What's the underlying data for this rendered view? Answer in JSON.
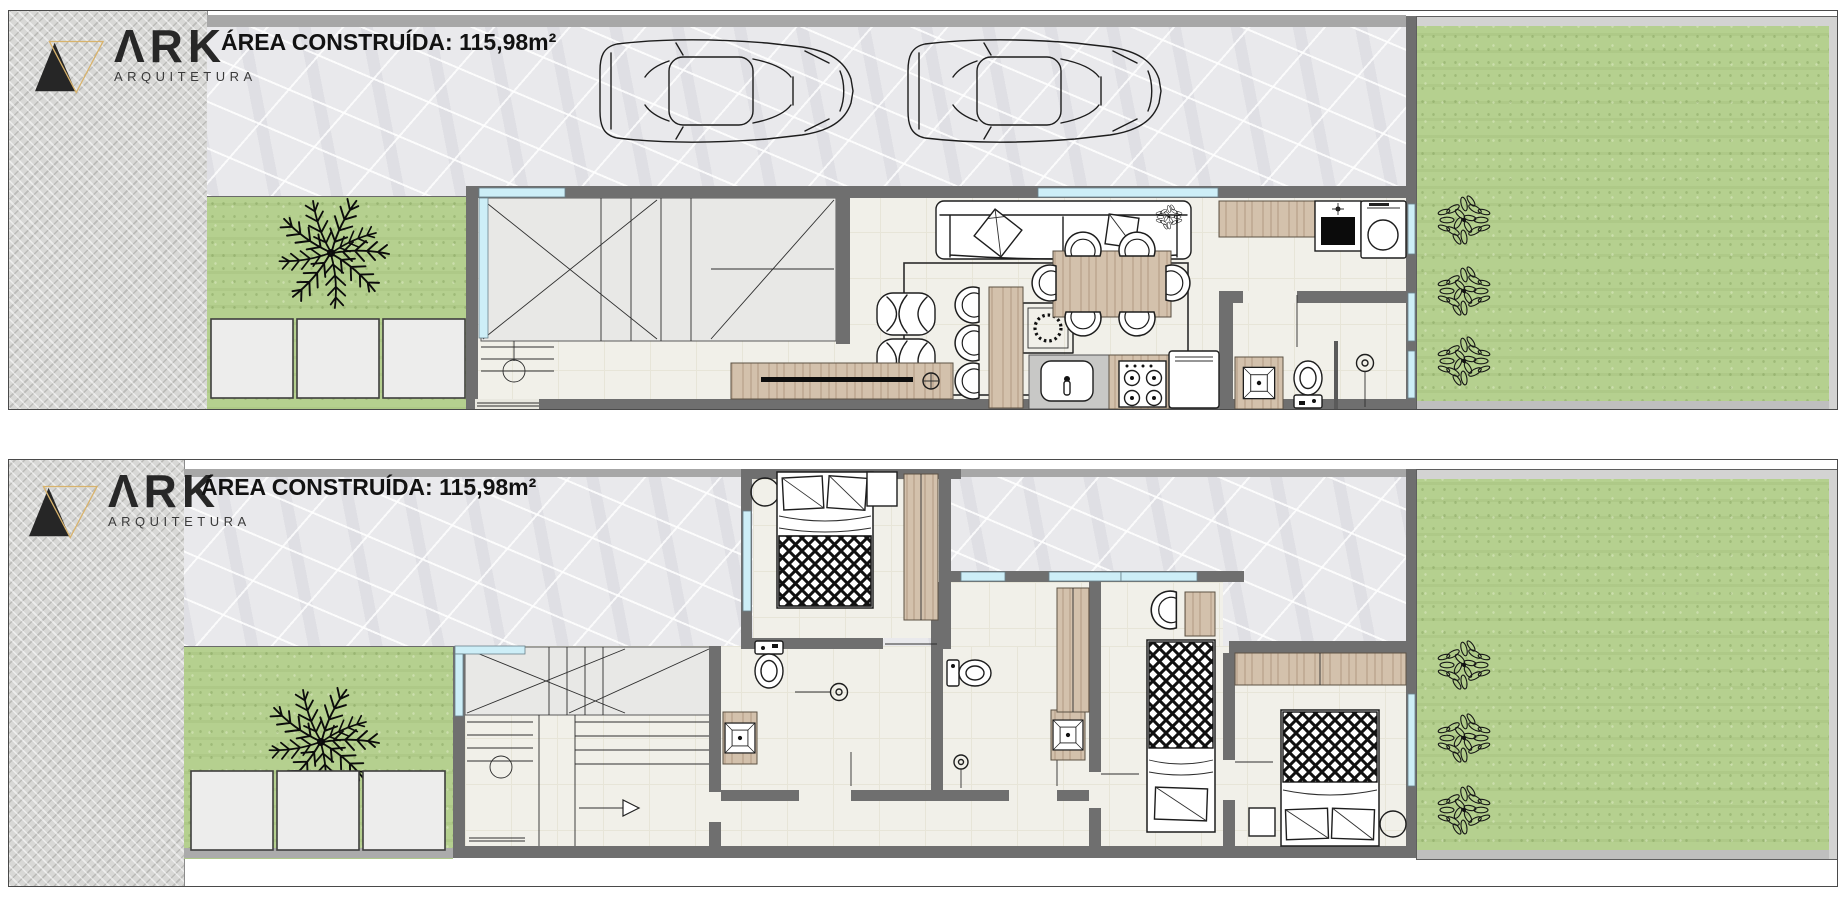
{
  "branding": {
    "name": "ARK",
    "logo_display": "ΛRK",
    "subtitle": "ARQUITETURA"
  },
  "plans": [
    {
      "id": "pavimento-1",
      "area_label": "ÁREA CONSTRUÍDA: 115,98m²"
    },
    {
      "id": "pavimento-2",
      "area_label": "ÁREA CONSTRUÍDA: 115,98m²"
    }
  ],
  "colors": {
    "wall": "#6f6f6f",
    "window": "#cdeef7",
    "grass": "#b5d08f",
    "stone": "#e9e9ec",
    "cobble": "#d8d8d6",
    "floor": "#f1f0e9",
    "wood": "#d3c1ac",
    "gold": "#d8b36c",
    "line": "#1d1d1d"
  },
  "icons": {
    "logo-mark-icon": "double-triangle",
    "car-icon": "top-view-car-outline",
    "palm-tree-icon": "radial-fronds",
    "bush-icon": "leaf-cluster",
    "sofa-icon": "three-seat-sofa-with-pillows",
    "pouf-icon": "knitted-pouf",
    "dining-table-icon": "six-seat-table",
    "dining-chair-icon": "half-round-chair",
    "bar-stool-icon": "half-round-stool",
    "sink-icon": "rounded-basin-with-faucet",
    "stove-icon": "four-burner-cooktop",
    "fridge-icon": "refrigerator-top",
    "laundry-sink-icon": "dark-tank-sink",
    "washing-machine-icon": "front-load-drum",
    "washbasin-icon": "beveled-square-basin",
    "toilet-icon": "tank-and-bowl",
    "shower-head-icon": "head-with-arm",
    "shower-drain-icon": "round-drain",
    "stairs-icon": "treads-with-break-lines",
    "stair-arrow-icon": "direction-arrow",
    "bed-icon": "bed-with-diamond-duvet",
    "armchair-icon": "half-round-armchair",
    "wardrobe-icon": "wood-panel-cabinet"
  },
  "legend": {
    "ground_floor_items": [
      "driveway",
      "car",
      "car",
      "front-yard",
      "palm-tree",
      "pavers",
      "stairs",
      "entry-door",
      "sofa",
      "rug",
      "poufs",
      "tv-console",
      "bar-counter",
      "bar-stools",
      "dining-table",
      "dining-chairs",
      "kitchen-sink",
      "stove",
      "fridge",
      "laundry-sink",
      "washing-machine",
      "washbasin",
      "toilet",
      "shower-drain",
      "garden",
      "bushes"
    ],
    "upper_floor_items": [
      "terrace",
      "stairs",
      "double-bed",
      "bedside-table",
      "wardrobe",
      "bathroom-toilet",
      "shower-head",
      "washbasin",
      "second-bathroom-toilet",
      "washbasin",
      "single-bed",
      "armchair",
      "wardrobe",
      "master-bed",
      "wardrobe",
      "stool",
      "side-table",
      "front-yard",
      "palm-tree",
      "pavers",
      "garden",
      "bushes"
    ]
  }
}
